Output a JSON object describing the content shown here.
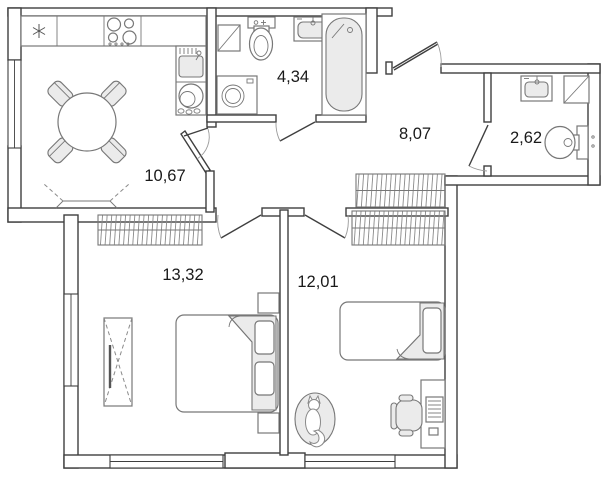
{
  "plan": {
    "type": "apartment-floor-plan",
    "rooms": [
      {
        "id": "kitchen",
        "area": "10,67"
      },
      {
        "id": "bathroom",
        "area": "4,34"
      },
      {
        "id": "hallway",
        "area": "8,07"
      },
      {
        "id": "wc",
        "area": "2,62"
      },
      {
        "id": "bedroom-left",
        "area": "13,32"
      },
      {
        "id": "bedroom-right",
        "area": "12,01"
      }
    ],
    "colors": {
      "wall": "#3f3f3f",
      "furniture": "#777777",
      "furniture_fill": "#ebebeb",
      "label": "#1a1a1a",
      "background": "#ffffff"
    }
  }
}
